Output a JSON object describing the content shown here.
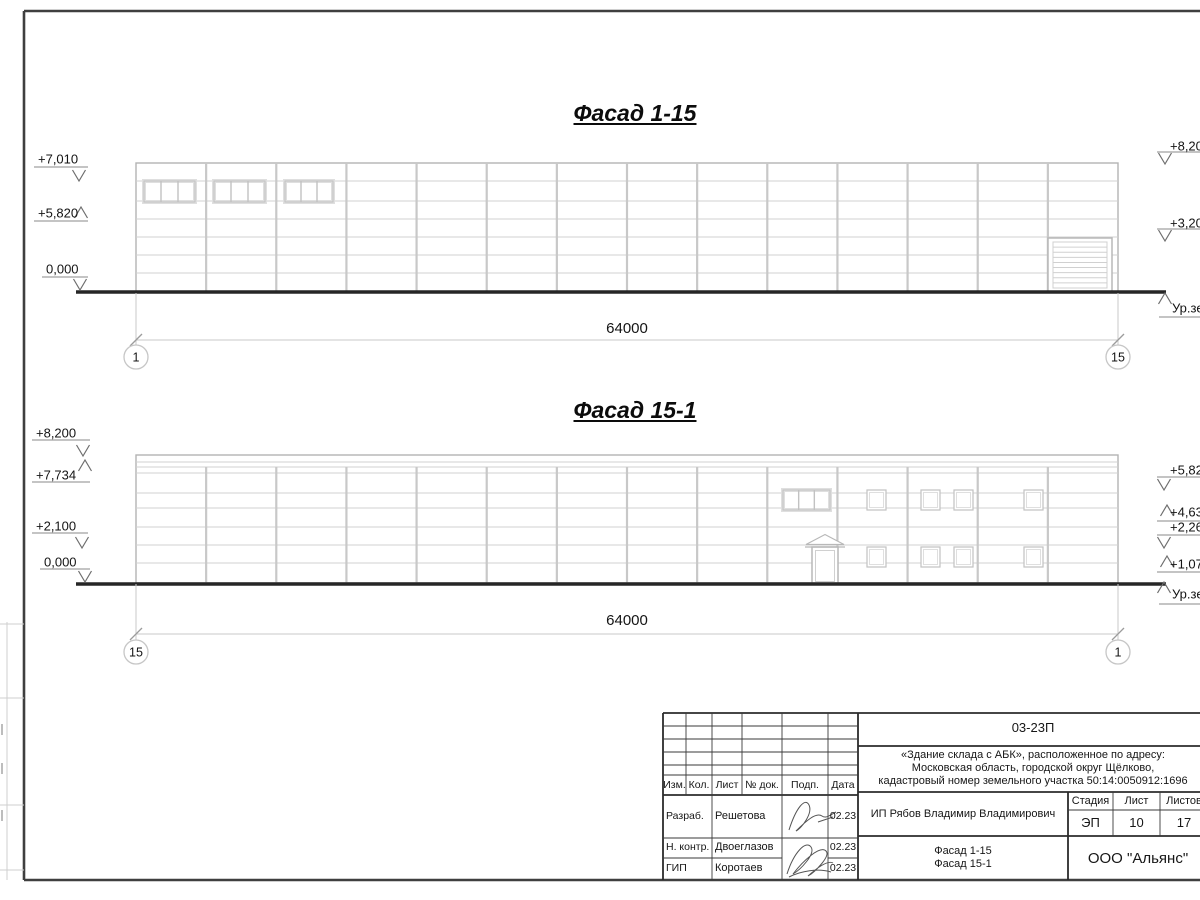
{
  "facade1": {
    "name": "facade-1-15",
    "title": "Фасад 1-15",
    "dimension": "64000",
    "geometry": {
      "x": 136,
      "top": 163,
      "bottom": 292,
      "w": 982,
      "bays": 14,
      "vert_top": 163,
      "joints": [
        181,
        201,
        219,
        237,
        255,
        273
      ],
      "windows": [
        {
          "x": 144,
          "y": 181,
          "w": 51,
          "h": 21,
          "panes": 3
        },
        {
          "x": 214,
          "y": 181,
          "w": 51,
          "h": 21,
          "panes": 3
        },
        {
          "x": 285,
          "y": 181,
          "w": 48,
          "h": 21,
          "panes": 3
        }
      ],
      "gate": {
        "x": 1048,
        "y": 238,
        "w": 64,
        "h": 54,
        "slats": 8
      },
      "ground": {
        "y": 292,
        "x1": 76,
        "x2": 1166
      },
      "dim": {
        "y": 340,
        "x1": 136,
        "x2": 1118,
        "text_x": 627,
        "text_y": 320
      },
      "circle_y": 357,
      "axes": [
        {
          "x": 136,
          "label": "1"
        },
        {
          "x": 1118,
          "label": "15"
        }
      ]
    },
    "left_markers": [
      {
        "label": "+7,010",
        "tx": 38,
        "ty": 152,
        "lx1": 34,
        "lx2": 88,
        "ly": 167,
        "ax": 79,
        "tip": 181,
        "dir": "down"
      },
      {
        "label": "+5,820",
        "tx": 38,
        "ty": 206,
        "lx1": 34,
        "lx2": 88,
        "ly": 221,
        "ax": 81,
        "tip": 207,
        "dir": "up"
      },
      {
        "label": "0,000",
        "tx": 46,
        "ty": 262,
        "lx1": 42,
        "lx2": 88,
        "ly": 277,
        "ax": 80,
        "tip": 290,
        "dir": "down"
      }
    ],
    "right_markers": [
      {
        "label": "+8,200",
        "tx": 1170,
        "ty": 139,
        "lx1": 1157,
        "lx2": 1212,
        "ly": 152,
        "ax": 1165,
        "tip": 164,
        "dir": "down"
      },
      {
        "label": "+3,200",
        "tx": 1170,
        "ty": 216,
        "lx1": 1157,
        "lx2": 1212,
        "ly": 229,
        "ax": 1165,
        "tip": 241,
        "dir": "down"
      },
      {
        "label": "Ур.земли",
        "tx": 1172,
        "ty": 301,
        "lx1": 1159,
        "lx2": 1212,
        "ly": 317,
        "ax": 1165,
        "tip": 293,
        "dir": "up"
      }
    ]
  },
  "facade2": {
    "name": "facade-15-1",
    "title": "Фасад 15-1",
    "dimension": "64000",
    "geometry": {
      "x": 136,
      "top": 455,
      "bottom": 583,
      "w": 982,
      "bays": 14,
      "vert_top": 467,
      "joints": [
        462,
        467,
        473,
        493,
        508,
        527,
        545,
        563
      ],
      "windows": [
        {
          "x": 783,
          "y": 490,
          "w": 47,
          "h": 20,
          "panes": 3
        },
        {
          "x": 867,
          "y": 490,
          "w": 19,
          "h": 20,
          "panes": 1
        },
        {
          "x": 921,
          "y": 490,
          "w": 19,
          "h": 20,
          "panes": 1
        },
        {
          "x": 954,
          "y": 490,
          "w": 19,
          "h": 20,
          "panes": 1
        },
        {
          "x": 1024,
          "y": 490,
          "w": 19,
          "h": 20,
          "panes": 1
        },
        {
          "x": 867,
          "y": 547,
          "w": 19,
          "h": 20,
          "panes": 1
        },
        {
          "x": 921,
          "y": 547,
          "w": 19,
          "h": 20,
          "panes": 1
        },
        {
          "x": 954,
          "y": 547,
          "w": 19,
          "h": 20,
          "panes": 1
        },
        {
          "x": 1024,
          "y": 547,
          "w": 19,
          "h": 20,
          "panes": 1
        }
      ],
      "door": {
        "x": 812,
        "y": 547,
        "w": 26,
        "h": 36
      },
      "ground": {
        "y": 584,
        "x1": 76,
        "x2": 1166
      },
      "dim": {
        "y": 634,
        "x1": 136,
        "x2": 1118,
        "text_x": 627,
        "text_y": 612
      },
      "circle_y": 652,
      "axes": [
        {
          "x": 136,
          "label": "15"
        },
        {
          "x": 1118,
          "label": "1"
        }
      ]
    },
    "left_markers": [
      {
        "label": "+8,200",
        "tx": 36,
        "ty": 426,
        "lx1": 32,
        "lx2": 90,
        "ly": 440,
        "ax": 83,
        "tip": 456,
        "dir": "down"
      },
      {
        "label": "+7,734",
        "tx": 36,
        "ty": 468,
        "lx1": 32,
        "lx2": 90,
        "ly": 482,
        "ax": 85,
        "tip": 460,
        "dir": "up"
      },
      {
        "label": "+2,100",
        "tx": 36,
        "ty": 519,
        "lx1": 32,
        "lx2": 88,
        "ly": 533,
        "ax": 82,
        "tip": 548,
        "dir": "down"
      },
      {
        "label": "0,000",
        "tx": 44,
        "ty": 555,
        "lx1": 40,
        "lx2": 90,
        "ly": 569,
        "ax": 85,
        "tip": 582,
        "dir": "down"
      }
    ],
    "right_markers": [
      {
        "label": "+5,820",
        "tx": 1170,
        "ty": 463,
        "lx1": 1157,
        "lx2": 1212,
        "ly": 477,
        "ax": 1164,
        "tip": 490,
        "dir": "down"
      },
      {
        "label": "+4,630",
        "tx": 1170,
        "ty": 505,
        "lx1": 1157,
        "lx2": 1212,
        "ly": 521,
        "ax": 1167,
        "tip": 505,
        "dir": "up"
      },
      {
        "label": "+2,260",
        "tx": 1170,
        "ty": 520,
        "lx1": 1157,
        "lx2": 1212,
        "ly": 535,
        "ax": 1164,
        "tip": 548,
        "dir": "down"
      },
      {
        "label": "+1,070",
        "tx": 1170,
        "ty": 557,
        "lx1": 1157,
        "lx2": 1212,
        "ly": 572,
        "ax": 1167,
        "tip": 556,
        "dir": "up"
      },
      {
        "label": "Ур.земли",
        "tx": 1172,
        "ty": 587,
        "lx1": 1159,
        "lx2": 1212,
        "ly": 604,
        "ax": 1164,
        "tip": 582,
        "dir": "up"
      }
    ]
  },
  "title_block": {
    "code": "03-23П",
    "description_lines": [
      "«Здание склада с АБК», расположенное по адресу:",
      "Московская область, городской округ Щёлково,",
      "кадастровый номер земельного участка 50:14:0050912:1696"
    ],
    "columns": {
      "izm": "Изм.",
      "kol": "Кол.",
      "list": "Лист",
      "doc": "№ док.",
      "podp": "Подп.",
      "data": "Дата"
    },
    "rows": [
      {
        "role": "Разраб.",
        "name": "Решетова",
        "date": "02.23"
      },
      {
        "role": "Н. контр.",
        "name": "Двоеглазов",
        "date": "02.23"
      },
      {
        "role": "ГИП",
        "name": "Коротаев",
        "date": "02.23"
      }
    ],
    "customer": "ИП Рябов Владимир Владимирович",
    "stage_label": "Стадия",
    "sheet_label": "Лист",
    "sheets_label": "Листов",
    "stage": "ЭП",
    "sheet_num": "10",
    "sheets_total": "17",
    "sheet_title_line1": "Фасад 1-15",
    "sheet_title_line2": "Фасад 15-1",
    "org": "ООО \"Альянс\""
  }
}
